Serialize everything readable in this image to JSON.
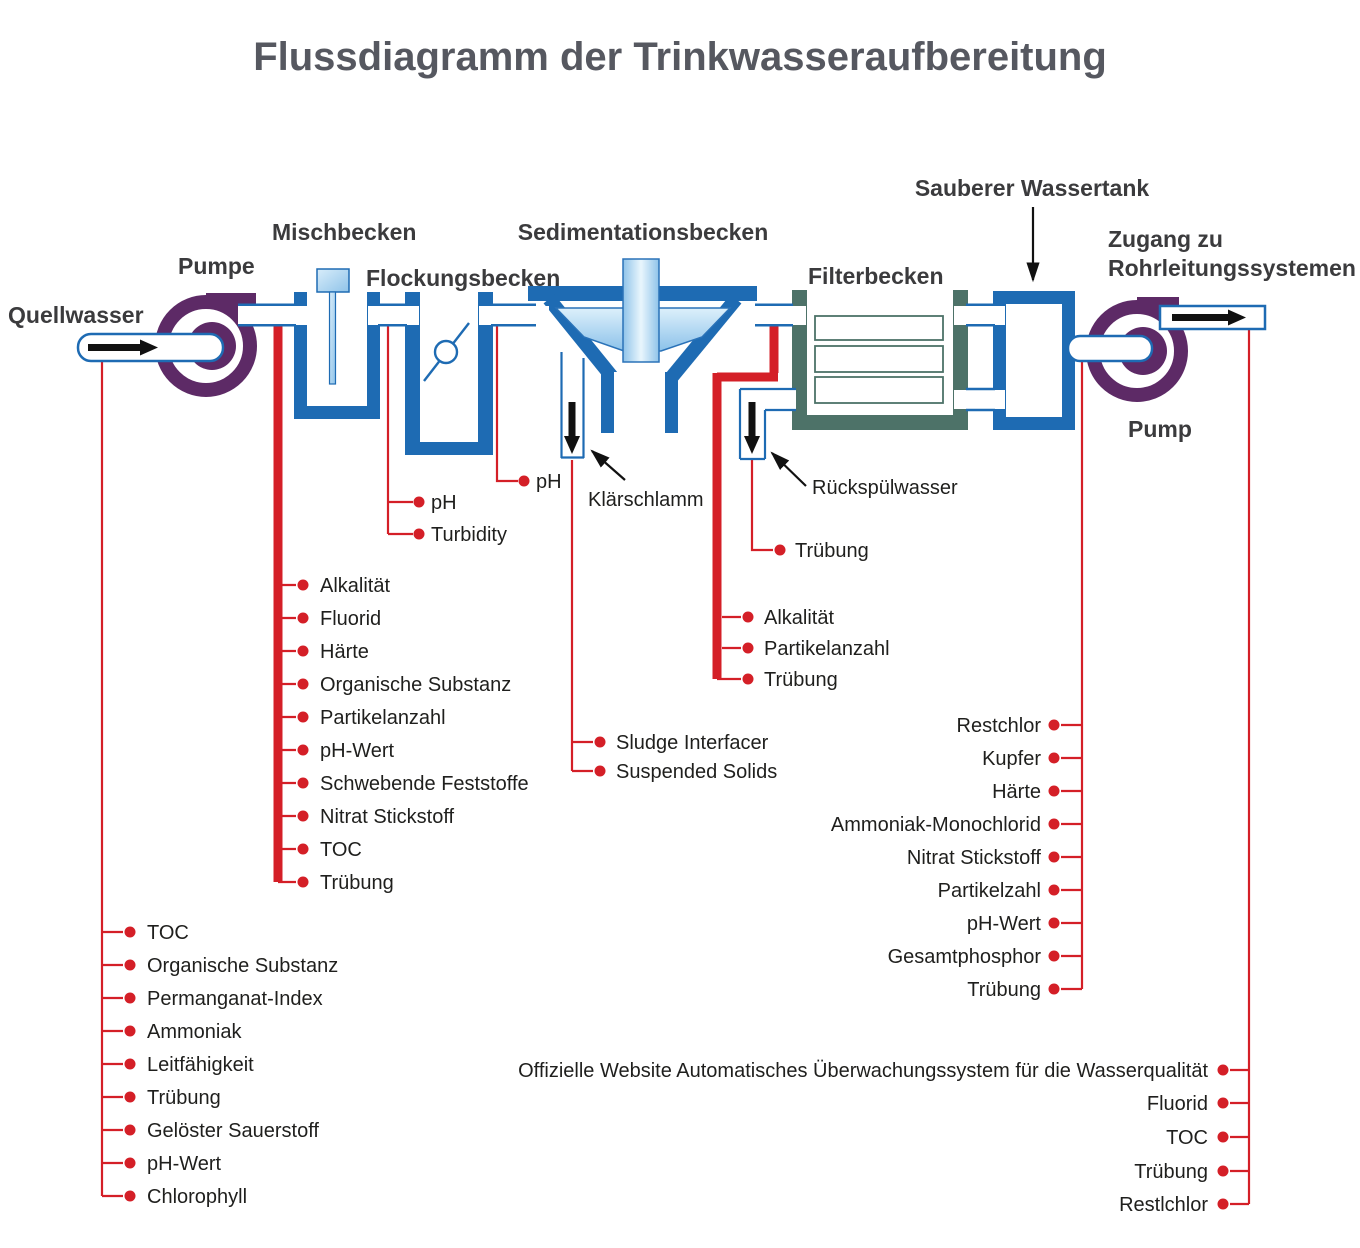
{
  "title": "Flussdiagramm der Trinkwasseraufbereitung",
  "colors": {
    "pipe_blue": "#1e6bb3",
    "filter_teal": "#4d7268",
    "pump_purple": "#5d2a66",
    "monitor_red": "#d41f27",
    "title_gray": "#565860",
    "heading_dark": "#3b3b3d",
    "item_dark": "#1f1f1d"
  },
  "stages": {
    "source": "Quellwasser",
    "pump_inlet": "Pumpe",
    "mixing_basin": "Mischbecken",
    "flocculation_basin": "Flockungsbecken",
    "sedimentation_basin": "Sedimentationsbecken",
    "filter_basin": "Filterbecken",
    "clean_water_tank": "Sauberer Wassertank",
    "pipe_access_line1": "Zugang zu",
    "pipe_access_line2": "Rohrleitungssystemen",
    "pump_outlet": "Pump"
  },
  "outlets": {
    "sludge": "Klärschlamm",
    "backwash": "Rückspülwasser"
  },
  "monitoring": {
    "source_water": {
      "items": [
        "TOC",
        "Organische Substanz",
        "Permanganat-Index",
        "Ammoniak",
        "Leitfähigkeit",
        "Trübung",
        "Gelöster Sauerstoff",
        "pH-Wert",
        "Chlorophyll"
      ]
    },
    "after_inlet_pump": {
      "items": [
        "Alkalität",
        "Fluorid",
        "Härte",
        "Organische Substanz",
        "Partikelanzahl",
        "pH-Wert",
        "Schwebende Feststoffe",
        "Nitrat Stickstoff",
        "TOC",
        "Trübung"
      ]
    },
    "mixing_outlet": {
      "items": [
        "pH",
        "Turbidity"
      ]
    },
    "flocculation_outlet": {
      "items": [
        "pH"
      ]
    },
    "sludge_line": {
      "items": [
        "Sludge Interfacer",
        "Suspended Solids"
      ]
    },
    "sedimentation_outlet": {
      "items": [
        "Alkalität",
        "Partikelanzahl",
        "Trübung"
      ]
    },
    "backwash_line": {
      "items": [
        "Trübung"
      ]
    },
    "tank_outlet": {
      "items": [
        "Restchlor",
        "Kupfer",
        "Härte",
        "Ammoniak-Monochlorid",
        "Nitrat Stickstoff",
        "Partikelzahl",
        "pH-Wert",
        "Gesamtphosphor",
        "Trübung"
      ]
    },
    "distribution": {
      "items": [
        "Offizielle Website Automatisches Überwachungssystem für die Wasserqualität",
        "Fluorid",
        "TOC",
        "Trübung",
        "Restlchlor"
      ]
    }
  }
}
